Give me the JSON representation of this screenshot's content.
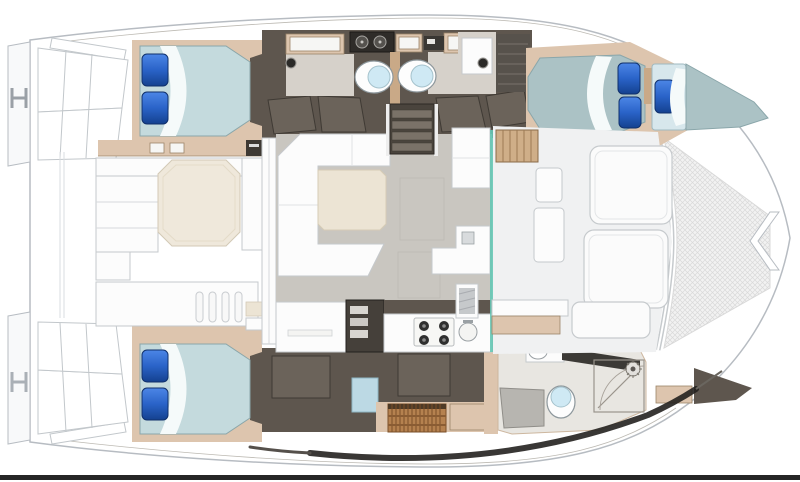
{
  "figure": {
    "kind": "Catamaran deck floor plan",
    "orientation": "bow-right",
    "note": "top-down layout drawing, no text labels in image"
  },
  "palette": {
    "hull_stroke": "#b7bcc2",
    "deck_soft": "#f0f1f2",
    "platform": "#f8f9fa",
    "tan": "#ddc5ae",
    "tan_dark": "#c9a987",
    "tan_line": "#9c8468",
    "brown": "#5e564e",
    "brown_dark": "#3f3a34",
    "brown_panel": "#6b635a",
    "floor_gray": "#c9c6c0",
    "floor_light": "#d6d1ca",
    "cream": "#ece4d4",
    "cream_table": "#efe8db",
    "furn_stroke": "#c5c9cc",
    "mattress": "#c4dadd",
    "mattress_fwd": "#abc2c5",
    "mattress_stroke": "#8aa6aa",
    "sheet": "#f5fafa",
    "pad_pale": "#d7e7ec",
    "pillow_hi": "#4c86e6",
    "pillow_mid": "#2a63c8",
    "pillow_lo": "#14418f",
    "toilet_lid": "#cfe9f4",
    "teal": "#66c7b5",
    "mesh_bg": "#f2f2f2",
    "mesh_line": "#d9d9d9",
    "wood": "#b5814f",
    "wood_dark": "#7a4f28",
    "steel_dark": "#35322e",
    "mat_gray": "#b7b5b0",
    "shadow_dark": "#23211f",
    "bottom_bar": "#262626"
  },
  "elements": {
    "hulls": [
      "port hull (top)",
      "starboard hull (bottom)"
    ],
    "rooms": [
      "aft double cabin port",
      "twin heads with toilets and twin-sink vanity",
      "forward double cabin with bow berth",
      "aft double cabin starboard",
      "head with shower and washer",
      "salon with U-sofa and table",
      "galley with stove, sink and shelf unit",
      "aft cockpit with octagonal table",
      "foredeck sunpads",
      "bow trampoline"
    ],
    "icons": [
      "toilet-icon",
      "stove-burners-icon",
      "sink-icon",
      "shower-rose-icon",
      "mooring-cleat-icon",
      "pillow",
      "washer-icon",
      "teak-grate"
    ]
  }
}
